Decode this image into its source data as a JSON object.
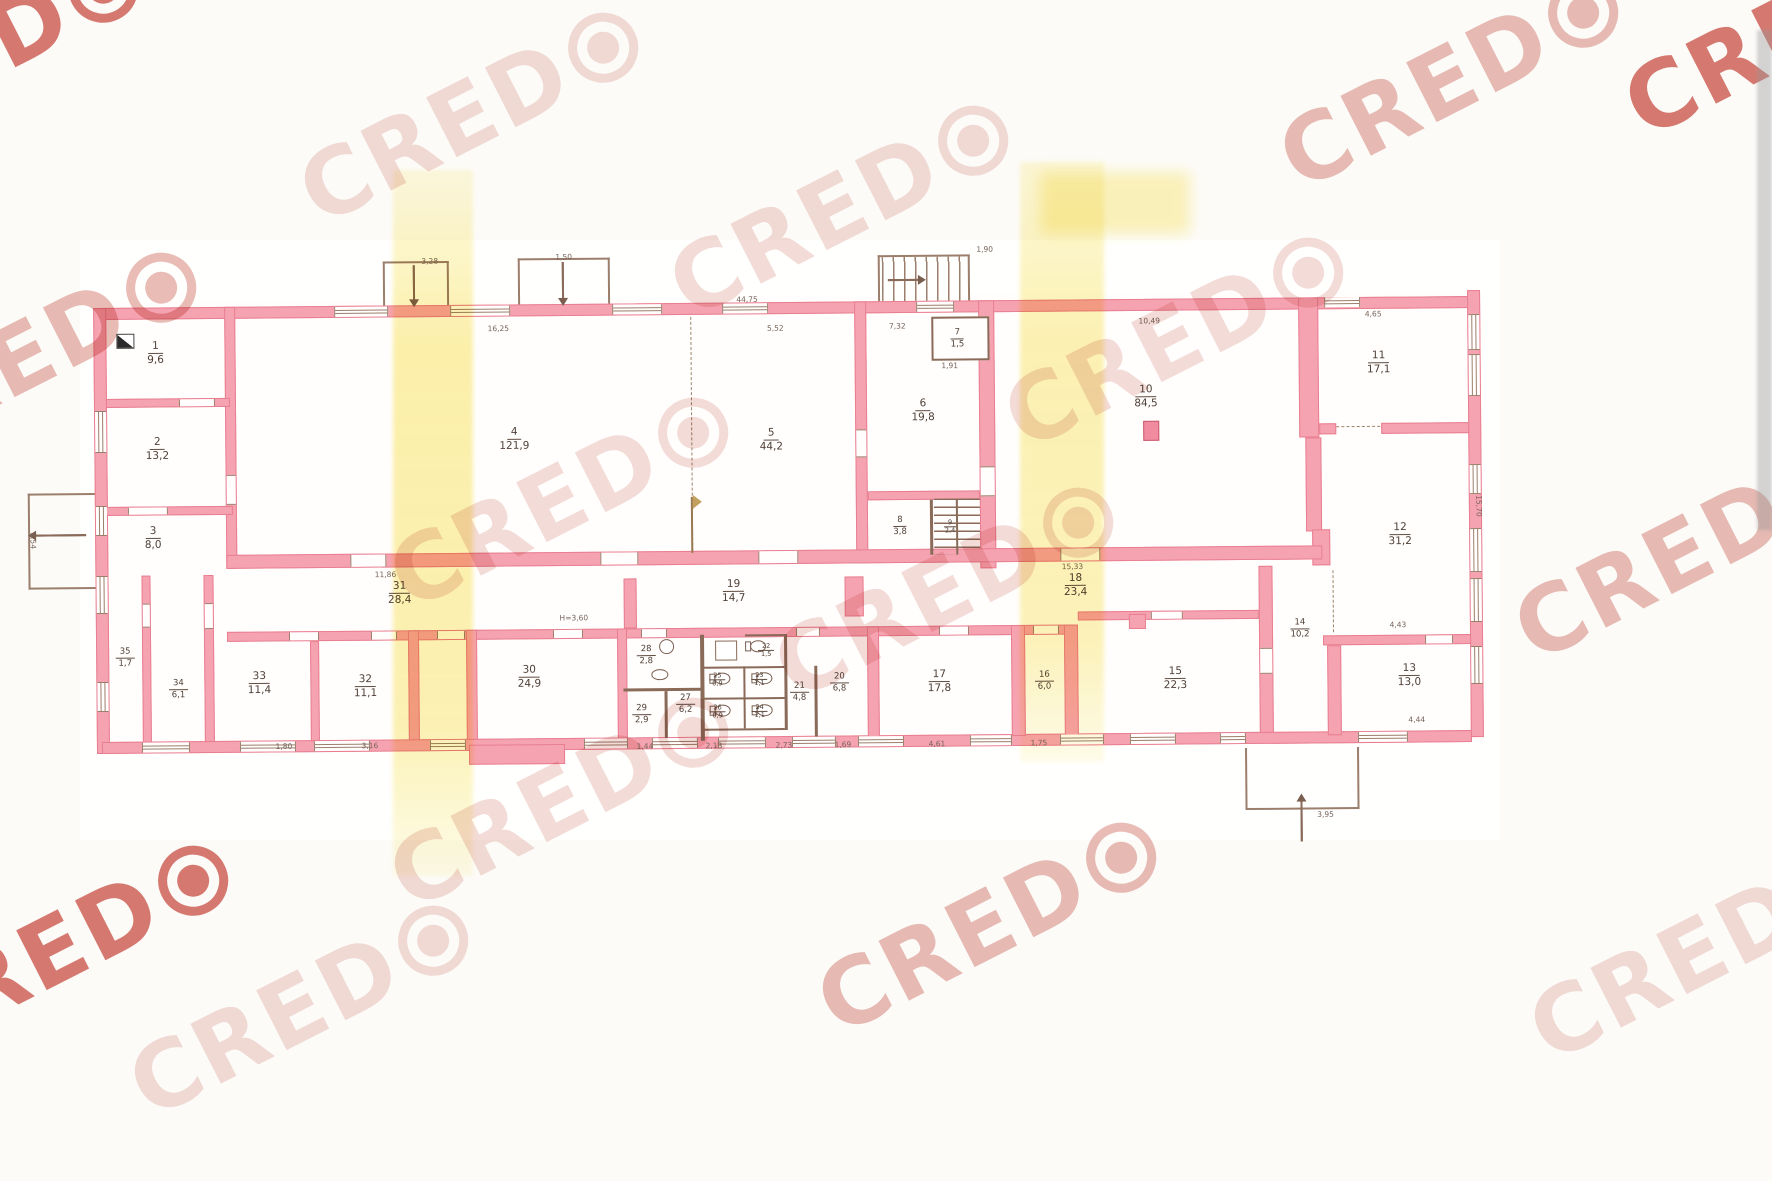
{
  "plan": {
    "watermark": {
      "text": "CRED",
      "symbol": "target-circle",
      "color_faint": "#f3dcd9",
      "color_strong": "#d87b73"
    },
    "colors": {
      "wall_fill": "#f6a3b1",
      "wall_edge": "#e87e90",
      "thin_line": "#8a6a58",
      "highlight_band": "#f8e469"
    },
    "height_note": "H=3,60",
    "rooms": [
      {
        "n": "1",
        "a": "9,6",
        "x": 157,
        "y": 348,
        "s": 0
      },
      {
        "n": "2",
        "a": "13,2",
        "x": 158,
        "y": 444,
        "s": 0
      },
      {
        "n": "3",
        "a": "8,0",
        "x": 153,
        "y": 533,
        "s": 0
      },
      {
        "n": "4",
        "a": "121,9",
        "x": 515,
        "y": 437,
        "s": 0
      },
      {
        "n": "5",
        "a": "44,2",
        "x": 772,
        "y": 440,
        "s": 0
      },
      {
        "n": "6",
        "a": "19,8",
        "x": 924,
        "y": 412,
        "s": 0
      },
      {
        "n": "7",
        "a": "1,5",
        "x": 959,
        "y": 340,
        "s": 1
      },
      {
        "n": "8",
        "a": "3,8",
        "x": 900,
        "y": 527,
        "s": 1
      },
      {
        "n": "9",
        "a": "2,4",
        "x": 950,
        "y": 528,
        "s": 2
      },
      {
        "n": "10",
        "a": "84,5",
        "x": 1147,
        "y": 400,
        "s": 0
      },
      {
        "n": "11",
        "a": "17,1",
        "x": 1380,
        "y": 368,
        "s": 0
      },
      {
        "n": "12",
        "a": "31,2",
        "x": 1400,
        "y": 540,
        "s": 0
      },
      {
        "n": "13",
        "a": "13,0",
        "x": 1408,
        "y": 681,
        "s": 0
      },
      {
        "n": "14",
        "a": "10,2",
        "x": 1299,
        "y": 633,
        "s": 1
      },
      {
        "n": "15",
        "a": "22,3",
        "x": 1174,
        "y": 682,
        "s": 0
      },
      {
        "n": "16",
        "a": "6,0",
        "x": 1043,
        "y": 683,
        "s": 1
      },
      {
        "n": "17",
        "a": "17,8",
        "x": 938,
        "y": 683,
        "s": 0
      },
      {
        "n": "18",
        "a": "23,4",
        "x": 1075,
        "y": 588,
        "s": 0
      },
      {
        "n": "19",
        "a": "14,7",
        "x": 733,
        "y": 591,
        "s": 0
      },
      {
        "n": "20",
        "a": "6,8",
        "x": 838,
        "y": 683,
        "s": 1
      },
      {
        "n": "21",
        "a": "4,8",
        "x": 798,
        "y": 692,
        "s": 1
      },
      {
        "n": "22",
        "a": "1,5",
        "x": 765,
        "y": 650,
        "s": 2
      },
      {
        "n": "23",
        "a": "1,1",
        "x": 758,
        "y": 679,
        "s": 2
      },
      {
        "n": "24",
        "a": "1,1",
        "x": 758,
        "y": 711,
        "s": 2
      },
      {
        "n": "25",
        "a": "0,9",
        "x": 716,
        "y": 679,
        "s": 2
      },
      {
        "n": "26",
        "a": "0,9",
        "x": 716,
        "y": 711,
        "s": 2
      },
      {
        "n": "27",
        "a": "6,2",
        "x": 684,
        "y": 703,
        "s": 1
      },
      {
        "n": "28",
        "a": "2,8",
        "x": 645,
        "y": 654,
        "s": 1
      },
      {
        "n": "29",
        "a": "2,9",
        "x": 640,
        "y": 713,
        "s": 1
      },
      {
        "n": "30",
        "a": "24,9",
        "x": 528,
        "y": 675,
        "s": 0
      },
      {
        "n": "31",
        "a": "28,4",
        "x": 399,
        "y": 590,
        "s": 0
      },
      {
        "n": "32",
        "a": "11,1",
        "x": 364,
        "y": 683,
        "s": 0
      },
      {
        "n": "33",
        "a": "11,4",
        "x": 258,
        "y": 679,
        "s": 0
      },
      {
        "n": "34",
        "a": "6,1",
        "x": 177,
        "y": 684,
        "s": 1
      },
      {
        "n": "35",
        "a": "1,7",
        "x": 124,
        "y": 652,
        "s": 1
      }
    ],
    "dimensions": [
      {
        "t": "3,28",
        "x": 432,
        "y": 258,
        "r": 0
      },
      {
        "t": "1,50",
        "x": 566,
        "y": 255,
        "r": 0
      },
      {
        "t": "44,75",
        "x": 749,
        "y": 299,
        "r": 0
      },
      {
        "t": "16,25",
        "x": 500,
        "y": 326,
        "r": 0
      },
      {
        "t": "5,52",
        "x": 777,
        "y": 328,
        "r": 0
      },
      {
        "t": "7,32",
        "x": 899,
        "y": 327,
        "r": 0
      },
      {
        "t": "1,90",
        "x": 987,
        "y": 251,
        "r": 0
      },
      {
        "t": "1,91",
        "x": 951,
        "y": 367,
        "r": 0
      },
      {
        "t": "10,49",
        "x": 1151,
        "y": 324,
        "r": 0
      },
      {
        "t": "4,65",
        "x": 1375,
        "y": 319,
        "r": 0
      },
      {
        "t": "11,86",
        "x": 385,
        "y": 571,
        "r": 0
      },
      {
        "t": "15,33",
        "x": 1072,
        "y": 569,
        "r": 0
      },
      {
        "t": "H=3,60",
        "x": 573,
        "y": 616,
        "r": 0
      },
      {
        "t": "4,43",
        "x": 1397,
        "y": 630,
        "r": 0
      },
      {
        "t": "4,44",
        "x": 1415,
        "y": 725,
        "r": 0
      },
      {
        "t": "3,95",
        "x": 1323,
        "y": 819,
        "r": 0
      },
      {
        "t": "1,44",
        "x": 643,
        "y": 745,
        "r": 0
      },
      {
        "t": "2,13",
        "x": 712,
        "y": 745,
        "r": 0
      },
      {
        "t": "2,73",
        "x": 782,
        "y": 745,
        "r": 0
      },
      {
        "t": "1,69",
        "x": 841,
        "y": 745,
        "r": 0
      },
      {
        "t": "4,61",
        "x": 935,
        "y": 745,
        "r": 0
      },
      {
        "t": "1,75",
        "x": 1037,
        "y": 745,
        "r": 0
      },
      {
        "t": "3,16",
        "x": 368,
        "y": 742,
        "r": 0
      },
      {
        "t": "1,80",
        "x": 282,
        "y": 742,
        "r": 0
      },
      {
        "t": "15,70",
        "x": 1479,
        "y": 512,
        "r": 90
      },
      {
        "t": "3,54",
        "x": 33,
        "y": 534,
        "r": 90
      }
    ],
    "watermarks": [
      {
        "x": -30,
        "y": 55,
        "c": "strong"
      },
      {
        "x": 470,
        "y": 115,
        "c": "faint"
      },
      {
        "x": 840,
        "y": 208,
        "c": "faint"
      },
      {
        "x": 1450,
        "y": 80,
        "c": "mid"
      },
      {
        "x": 1795,
        "y": 28,
        "c": "strong"
      },
      {
        "x": 28,
        "y": 355,
        "c": "mid"
      },
      {
        "x": 560,
        "y": 500,
        "c": "faint"
      },
      {
        "x": 945,
        "y": 590,
        "c": "faint"
      },
      {
        "x": 1175,
        "y": 340,
        "c": "faint"
      },
      {
        "x": 1685,
        "y": 552,
        "c": "mid"
      },
      {
        "x": 988,
        "y": 925,
        "c": "mid"
      },
      {
        "x": 60,
        "y": 948,
        "c": "strong"
      },
      {
        "x": 300,
        "y": 1008,
        "c": "faint"
      },
      {
        "x": 560,
        "y": 800,
        "c": "faint"
      },
      {
        "x": 1700,
        "y": 952,
        "c": "faint"
      }
    ]
  }
}
